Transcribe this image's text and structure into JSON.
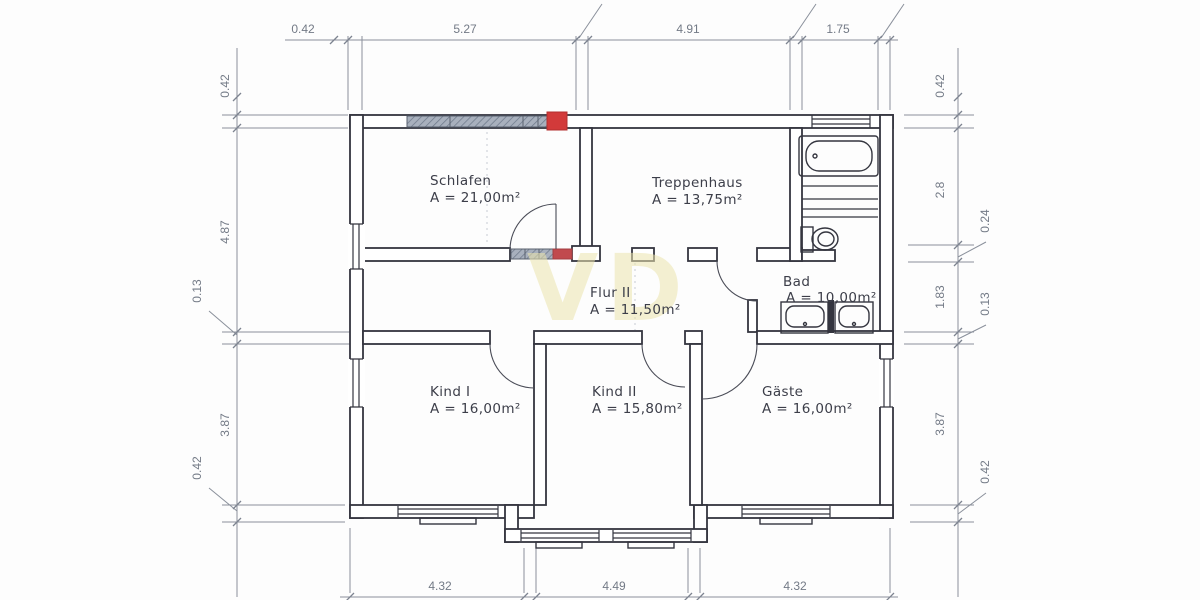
{
  "rooms": [
    {
      "name": "Schlafen",
      "area": "A = 21,00m²"
    },
    {
      "name": "Treppenhaus",
      "area": "A = 13,75m²"
    },
    {
      "name": "Flur II",
      "area": "A = 11,50m²"
    },
    {
      "name": "Bad",
      "area": "A = 10,00m²"
    },
    {
      "name": "Kind I",
      "area": "A = 16,00m²"
    },
    {
      "name": "Kind II",
      "area": "A = 15,80m²"
    },
    {
      "name": "Gäste",
      "area": "A = 16,00m²"
    }
  ],
  "dimensions": {
    "top": [
      "0.42",
      "5.27",
      "4.91",
      "1.75"
    ],
    "bottom": [
      "4.32",
      "4.49",
      "4.32"
    ],
    "left": [
      "0.42",
      "4.87",
      "0.13",
      "3.87",
      "0.42"
    ],
    "right": [
      "0.42",
      "2.8",
      "0.24",
      "1.83",
      "0.13",
      "3.87",
      "0.42"
    ]
  },
  "watermark": "VD",
  "colors": {
    "wall_line": "#34353f",
    "dimension_line": "#8a909b",
    "highlight_gray": "#a8b0bd",
    "highlight_red": "#d23a3a",
    "watermark": "#ece5ae"
  }
}
